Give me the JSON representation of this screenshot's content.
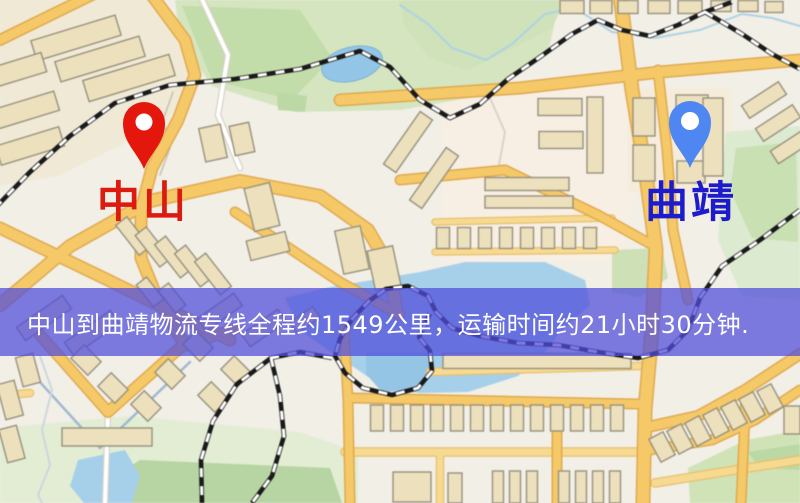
{
  "banner": {
    "text": "中山到曲靖物流专线全程约1549公里，运输时间约21小时30分钟.",
    "bg": "rgba(81,78,218,0.74)",
    "fg": "#ffffff"
  },
  "markers": {
    "origin": {
      "label": "中山",
      "pin_color": "#e3170c",
      "label_color": "#dd1a10"
    },
    "destination": {
      "label": "曲靖",
      "pin_color": "#4e87f2",
      "label_color": "#1c1ccd"
    }
  },
  "map": {
    "bg": "#f2efe7",
    "road_casing": "#dfa94f",
    "road_fill": "#f5c968",
    "minor_casing": "#e7c06c",
    "minor_fill": "#f7da92",
    "white_casing": "#d8d2c6",
    "white_fill": "#ffffff",
    "building_fill": "#ece0bd",
    "building_stroke": "#97917d",
    "rail_dark": "#1a1a1a",
    "rail_light": "#ffffff",
    "zones": [
      {
        "pts": "0,0 162,0 200,58 168,122 58,176 0,186",
        "fill": "#f0e9d6"
      },
      {
        "pts": "442,86 622,84 640,170 620,262 442,262",
        "fill": "#f7eee4"
      },
      {
        "pts": "628,88 732,88 732,192 628,192",
        "fill": "#f5ecdc"
      }
    ],
    "parks": [
      {
        "pts": "175,0 560,0 548,52 480,96 400,110 295,112 212,86 180,40",
        "fill": "#d5e5bf"
      },
      {
        "pts": "182,6 300,10 332,58 292,100 212,80",
        "fill": "#c2dcaa"
      },
      {
        "pts": "277,92 307,96 305,112 278,110",
        "fill": "#bcd8a4"
      },
      {
        "pts": "400,0 565,0 552,28 505,52 468,70 430,58 405,28",
        "fill": "#cfe2ba"
      },
      {
        "pts": "726,132 800,126 800,300 742,296 718,240 722,178",
        "fill": "#dcead0"
      },
      {
        "pts": "736,148 796,142 798,242 752,238 730,190",
        "fill": "#c9e0b2"
      },
      {
        "pts": "612,250 662,248 668,278 640,297 612,292",
        "fill": "#cde0b6"
      },
      {
        "pts": "0,428 130,416 300,432 358,452 358,503 0,503",
        "fill": "#e2edd4"
      },
      {
        "pts": "112,478 140,460 330,468 342,503 118,503",
        "fill": "#b7d5a2"
      },
      {
        "pts": "688,468 746,440 800,430 800,503 690,503",
        "fill": "#cfe3b6"
      },
      {
        "pts": "748,452 800,444 800,470 760,468",
        "fill": "#bcd8a4"
      }
    ],
    "water": [
      {
        "pts": "285,298 330,287 420,272 465,262 545,262 585,280 590,305 560,332 542,356 518,376 468,392 420,393 384,388 358,370 328,350 300,330",
        "fill": "#a6d0ea"
      },
      {
        "pts": "366,352 432,352 434,372 415,390 382,392 366,374",
        "fill": "#95c5e5"
      },
      {
        "pts": "70,486 78,460 125,450 140,476 132,503 84,503",
        "fill": "#a6d0ea"
      }
    ],
    "pond": {
      "cx": 352,
      "cy": 64,
      "rx": 31,
      "ry": 17,
      "rot": -14,
      "fill": "#93c6e6",
      "edge": "#7fb2d4"
    },
    "lines": [
      {
        "pts": "490,98 505,132 499,165 520,190",
        "w": 2,
        "c": "#d9d4c8"
      },
      {
        "pts": "400,5 428,24 452,48 486,60 512,44 545,14 575,8 612,32 655,38 700,30 742,14 772,18 800,26",
        "w": 2,
        "c": "#aed2e4"
      },
      {
        "pts": "18,358 100,448 190,362",
        "w": 2.5,
        "c": "#9fb9d0"
      },
      {
        "pts": "40,356 52,390 42,430 50,465 38,495 42,503",
        "w": 2,
        "c": "#cdd6dd"
      },
      {
        "pts": "173,92 163,120 170,148 160,175",
        "w": 1.5,
        "c": "#c6c0b2"
      }
    ],
    "white_roads": [
      {
        "pts": "200,-5 228,55 218,115 240,168",
        "w": 4
      },
      {
        "pts": "108,412 105,503",
        "w": 4
      }
    ],
    "minor_roads": [
      {
        "pts": "435,222 612,218",
        "w": 5
      },
      {
        "pts": "435,252 615,250",
        "w": 5
      },
      {
        "pts": "430,372 640,366",
        "w": 6
      },
      {
        "pts": "345,452 640,452",
        "w": 7
      },
      {
        "pts": "440,452 440,503",
        "w": 6
      },
      {
        "pts": "0,396 30,393",
        "w": 6
      },
      {
        "pts": "655,483 735,470 800,460",
        "w": 7
      }
    ],
    "major_roads": [
      {
        "pts": "0,40 98,-8",
        "w": 9
      },
      {
        "pts": "148,-10 185,40 195,75 178,120 152,168 141,210 141,258 158,300 185,345",
        "w": 10
      },
      {
        "pts": "0,305 70,246 150,201 240,181 320,196 368,230 390,268 396,310",
        "w": 11
      },
      {
        "pts": "0,228 108,280 230,340",
        "w": 10
      },
      {
        "pts": "235,212 340,282 400,315",
        "w": 8
      },
      {
        "pts": "340,100 520,88 660,72 800,60",
        "w": 10
      },
      {
        "pts": "620,-5 632,90 646,175 656,250 652,330 645,410 643,503",
        "w": 12
      },
      {
        "pts": "400,180 505,170 600,216 656,247",
        "w": 8
      },
      {
        "pts": "658,70 667,150 673,230 688,300",
        "w": 8
      },
      {
        "pts": "40,335 108,412 182,346 235,329",
        "w": 9
      },
      {
        "pts": "344,330 348,400 350,503",
        "w": 8
      },
      {
        "pts": "352,398 640,404",
        "w": 8
      },
      {
        "pts": "557,430 557,503",
        "w": 8
      },
      {
        "pts": "800,354 745,390 698,416 648,427",
        "w": 9
      },
      {
        "pts": "800,390 755,420 712,440 650,450",
        "w": 8
      },
      {
        "pts": "746,392 741,503",
        "w": 8
      }
    ],
    "railways": [
      {
        "pts": "-5,208 30,172 70,136 115,103 170,85 235,79 300,69 360,51 390,67 420,100 450,118 480,104 508,79 540,57 572,34 598,20 622,30 650,36 678,25 705,12 732,2"
      },
      {
        "pts": "705,12 742,34 772,54 800,69"
      },
      {
        "pts": "800,210 760,240 722,266 700,298 688,330 668,350 638,358 598,352 558,345 518,343 480,336 452,328 436,312 428,296 408,286 386,289 369,301 352,319 340,339 335,356 345,373 363,388 392,395 418,388 432,371 430,351 419,337 430,313"
      },
      {
        "pts": "332,358 300,352 271,358 237,384 213,421 201,460 202,503"
      },
      {
        "pts": "271,358 280,396 284,436 272,476 252,503"
      }
    ],
    "buildings": [
      [
        76,
        38,
        88,
        21,
        -17
      ],
      [
        100,
        59,
        88,
        21,
        -17
      ],
      [
        129,
        78,
        90,
        22,
        -17
      ],
      [
        18,
        70,
        54,
        20,
        -17
      ],
      [
        26,
        110,
        64,
        20,
        -17
      ],
      [
        30,
        146,
        66,
        20,
        -17
      ],
      [
        213,
        143,
        22,
        34,
        -12
      ],
      [
        242,
        139,
        20,
        30,
        -12
      ],
      [
        262,
        207,
        26,
        44,
        -14
      ],
      [
        268,
        246,
        40,
        20,
        -14
      ],
      [
        133,
        236,
        14,
        38,
        -38
      ],
      [
        153,
        247,
        14,
        40,
        -38
      ],
      [
        173,
        257,
        14,
        42,
        -38
      ],
      [
        193,
        266,
        14,
        42,
        -38
      ],
      [
        213,
        274,
        14,
        42,
        -38
      ],
      [
        150,
        292,
        13,
        28,
        -38
      ],
      [
        172,
        298,
        13,
        28,
        -38
      ],
      [
        408,
        142,
        64,
        15,
        -55
      ],
      [
        434,
        178,
        64,
        15,
        -55
      ],
      [
        352,
        250,
        26,
        44,
        -12
      ],
      [
        384,
        268,
        26,
        40,
        -12
      ],
      [
        44,
        318,
        56,
        16,
        -35
      ],
      [
        92,
        333,
        56,
        16,
        -35
      ],
      [
        220,
        312,
        44,
        15,
        -35
      ],
      [
        264,
        328,
        44,
        15,
        -35
      ],
      [
        305,
        320,
        28,
        13,
        -35
      ],
      [
        560,
        107,
        44,
        17,
        0
      ],
      [
        561,
        140,
        44,
        17,
        0
      ],
      [
        595,
        135,
        16,
        76,
        0
      ],
      [
        527,
        184,
        84,
        13,
        0
      ],
      [
        529,
        202,
        88,
        12,
        0
      ],
      [
        443,
        238,
        13,
        21,
        0
      ],
      [
        464,
        238,
        13,
        21,
        0
      ],
      [
        485,
        238,
        13,
        21,
        0
      ],
      [
        506,
        238,
        13,
        21,
        0
      ],
      [
        527,
        238,
        13,
        21,
        0
      ],
      [
        548,
        238,
        13,
        21,
        0
      ],
      [
        569,
        238,
        13,
        21,
        0
      ],
      [
        590,
        238,
        13,
        21,
        0
      ],
      [
        644,
        117,
        22,
        38,
        0
      ],
      [
        644,
        163,
        22,
        36,
        0
      ],
      [
        692,
        108,
        32,
        26,
        0
      ],
      [
        691,
        172,
        28,
        22,
        0
      ],
      [
        713,
        137,
        20,
        78,
        0
      ],
      [
        572,
        7,
        24,
        13,
        0
      ],
      [
        601,
        7,
        22,
        13,
        0
      ],
      [
        628,
        7,
        20,
        13,
        0
      ],
      [
        659,
        7,
        22,
        13,
        0
      ],
      [
        690,
        7,
        24,
        13,
        0
      ],
      [
        721,
        6,
        20,
        11,
        0
      ],
      [
        748,
        6,
        20,
        11,
        0
      ],
      [
        774,
        7,
        18,
        11,
        0
      ],
      [
        764,
        100,
        44,
        15,
        -33
      ],
      [
        778,
        123,
        44,
        15,
        -33
      ],
      [
        792,
        146,
        42,
        15,
        -33
      ],
      [
        537,
        361,
        188,
        15,
        0
      ],
      [
        377,
        418,
        13,
        26,
        0
      ],
      [
        397,
        418,
        13,
        26,
        0
      ],
      [
        417,
        418,
        13,
        26,
        0
      ],
      [
        437,
        418,
        13,
        26,
        0
      ],
      [
        457,
        418,
        13,
        26,
        0
      ],
      [
        477,
        418,
        13,
        26,
        0
      ],
      [
        497,
        418,
        13,
        26,
        0
      ],
      [
        517,
        418,
        13,
        26,
        0
      ],
      [
        537,
        418,
        13,
        26,
        0
      ],
      [
        557,
        418,
        13,
        26,
        0
      ],
      [
        577,
        418,
        13,
        26,
        0
      ],
      [
        597,
        418,
        13,
        26,
        0
      ],
      [
        617,
        418,
        13,
        26,
        0
      ],
      [
        412,
        487,
        38,
        30,
        0
      ],
      [
        455,
        488,
        14,
        30,
        0
      ],
      [
        498,
        487,
        11,
        32,
        0
      ],
      [
        515,
        487,
        11,
        32,
        0
      ],
      [
        532,
        487,
        11,
        32,
        0
      ],
      [
        564,
        487,
        11,
        32,
        0
      ],
      [
        581,
        487,
        11,
        32,
        0
      ],
      [
        598,
        487,
        11,
        32,
        0
      ],
      [
        615,
        487,
        11,
        32,
        0
      ],
      [
        662,
        447,
        16,
        26,
        -28
      ],
      [
        680,
        439,
        16,
        26,
        -28
      ],
      [
        698,
        431,
        16,
        26,
        -28
      ],
      [
        716,
        423,
        16,
        26,
        -28
      ],
      [
        734,
        415,
        16,
        26,
        -28
      ],
      [
        752,
        407,
        16,
        26,
        -28
      ],
      [
        770,
        399,
        16,
        26,
        -28
      ],
      [
        792,
        420,
        16,
        28,
        0
      ],
      [
        10,
        400,
        18,
        36,
        -15
      ],
      [
        12,
        444,
        18,
        34,
        -15
      ],
      [
        28,
        370,
        18,
        30,
        -15
      ],
      [
        107,
        437,
        90,
        18,
        0
      ],
      [
        86,
        360,
        24,
        19,
        45
      ],
      [
        113,
        388,
        24,
        19,
        45
      ],
      [
        146,
        406,
        24,
        19,
        45
      ],
      [
        170,
        374,
        24,
        19,
        45
      ],
      [
        198,
        346,
        24,
        19,
        45
      ],
      [
        213,
        397,
        24,
        19,
        45
      ],
      [
        236,
        371,
        24,
        19,
        45
      ]
    ]
  }
}
